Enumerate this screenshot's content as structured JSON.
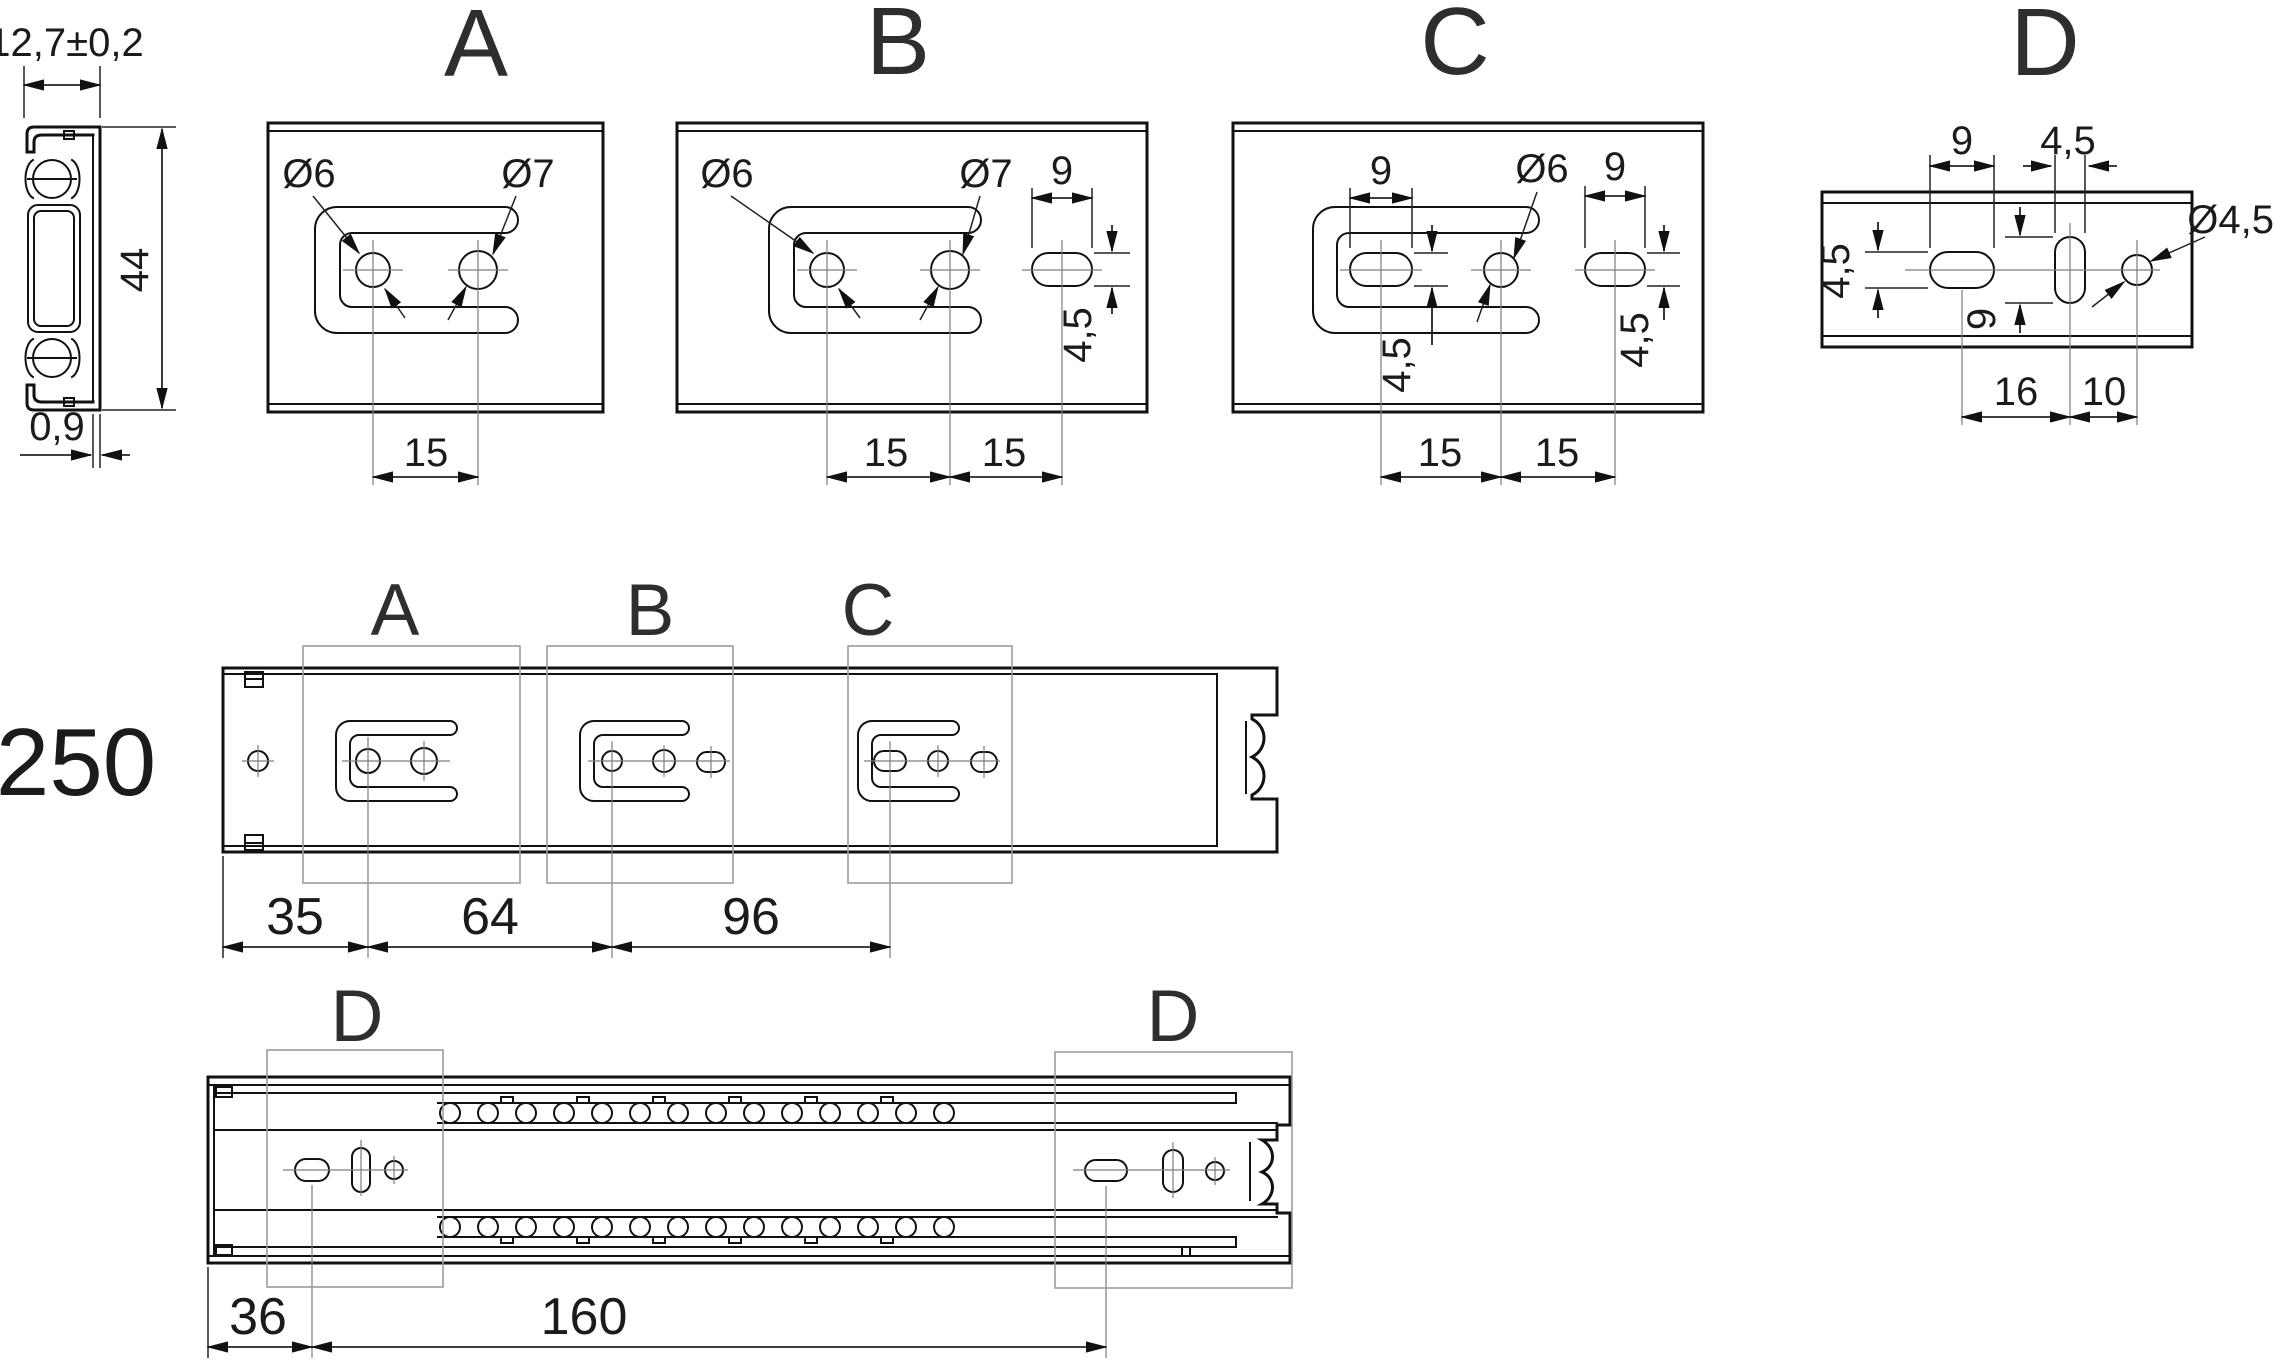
{
  "title": "Telescopic drawer slide 250 mm - mounting hole drawing",
  "cross_section": {
    "width": "12,7±0,2",
    "height": "44",
    "thickness": "0,9"
  },
  "details": {
    "a": {
      "label": "A",
      "hole_left": "Ø6",
      "hole_right": "Ø7",
      "pitch": "15"
    },
    "b": {
      "label": "B",
      "hole_left": "Ø6",
      "hole_right": "Ø7",
      "slot_width": "9",
      "slot_height": "4,5",
      "pitch_left": "15",
      "pitch_right": "15"
    },
    "c": {
      "label": "C",
      "slot_left_width": "9",
      "hole": "Ø6",
      "slot_right_width": "9",
      "slot_left_height": "4,5",
      "slot_right_height": "4,5",
      "pitch_left": "15",
      "pitch_right": "15"
    },
    "d": {
      "label": "D",
      "slot_width": "9",
      "mid_slot_width": "4,5",
      "hole": "Ø4,5",
      "slot_height": "4,5",
      "mid_slot_height": "9",
      "spacing_left": "16",
      "spacing_right": "10"
    }
  },
  "inner_rail_view": {
    "length": "250",
    "zone_a": "A",
    "zone_b": "B",
    "zone_c": "C",
    "dim_end_to_a": "35",
    "dim_a_to_b": "64",
    "dim_b_to_c": "96"
  },
  "outer_rail_view": {
    "zone_d_left": "D",
    "zone_d_right": "D",
    "dim_end_to_d": "36",
    "dim_d_to_d": "160"
  }
}
